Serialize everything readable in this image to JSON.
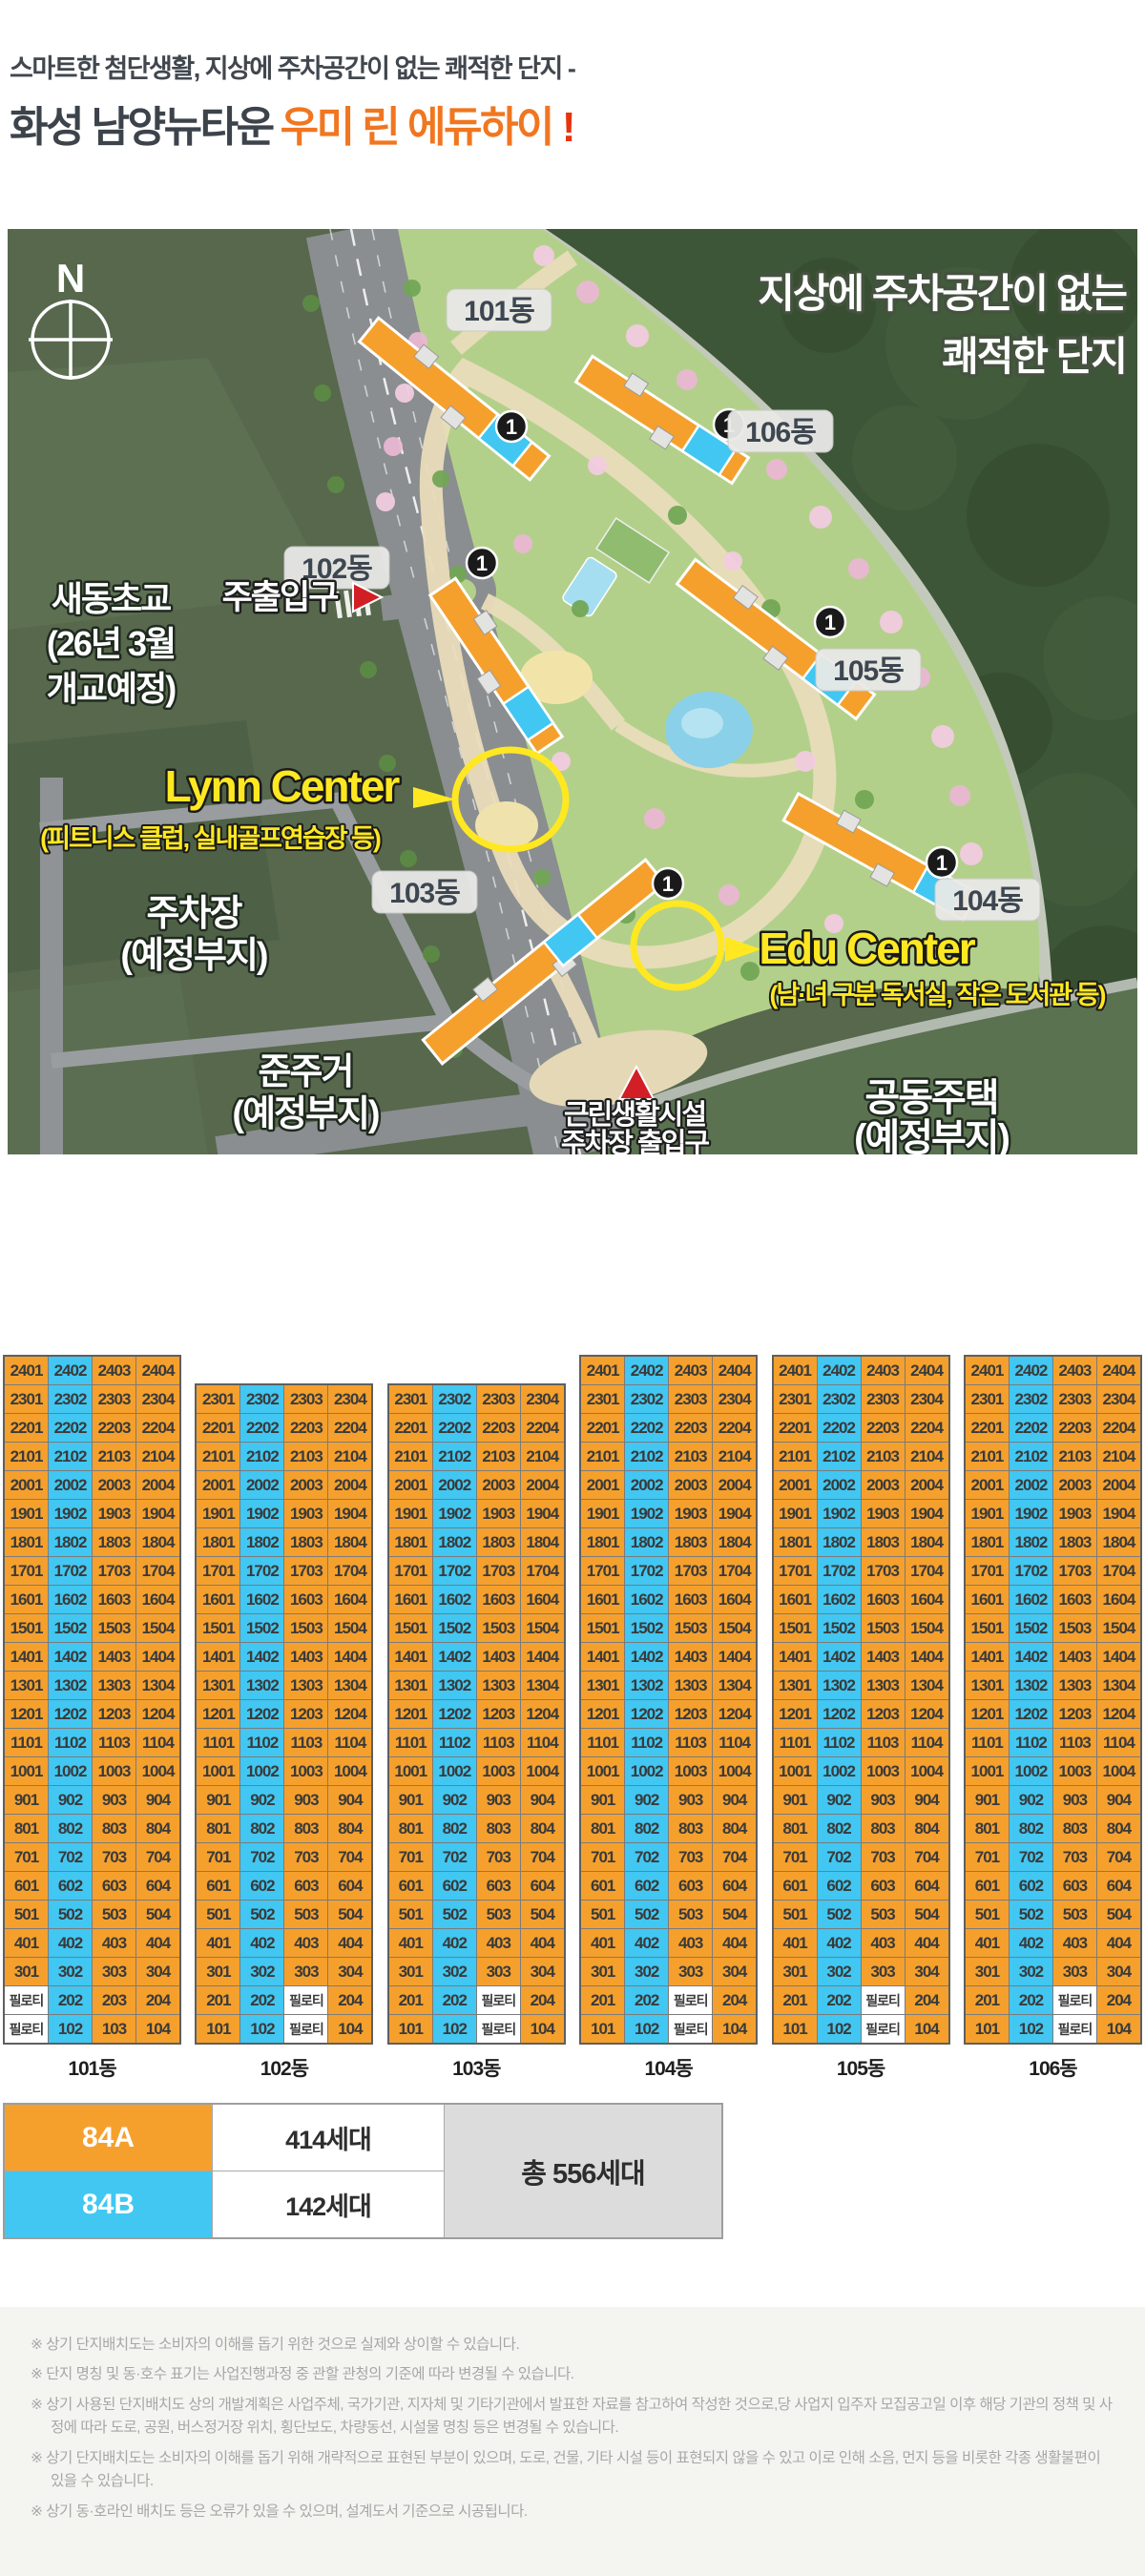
{
  "header": {
    "subtitle": "스마트한 첨단생활, 지상에 주차공간이 없는 쾌적한 단지 -",
    "title_dark": "화성 남양뉴타운",
    "title_orange": "우미 린 에듀하이",
    "title_bang": "!"
  },
  "map": {
    "compass": "N",
    "headline_line1": "지상에 주차공간이 없는",
    "headline_line2": "쾌적한 단지",
    "unit_marker": "1",
    "building_badges": [
      "101동",
      "106동",
      "102동",
      "105동",
      "103동",
      "104동"
    ],
    "annotations": {
      "main_entrance": "주출입구",
      "school_line1": "새동초교",
      "school_line2": "(26년 3월",
      "school_line3": "개교예정)",
      "lynn_title": "Lynn Center",
      "lynn_sub": "(피트니스 클럽, 실내골프연습장 등)",
      "edu_title": "Edu Center",
      "edu_sub": "(남·녀 구분 독서실, 작은 도서관 등)",
      "parking_line1": "주차장",
      "parking_line2": "(예정부지)",
      "semi_residential_line1": "준주거",
      "semi_residential_line2": "(예정부지)",
      "apartment_line1": "공동주택",
      "apartment_line2": "(예정부지)",
      "neighborhood_line1": "근린생활시설",
      "neighborhood_line2": "주차장 출입구"
    }
  },
  "stack_tables": {
    "piloti_label": "필로티",
    "columns": 4,
    "buildings": [
      {
        "label": "101동",
        "top_floor": 24,
        "blue_column": 2,
        "piloti_column": 1,
        "piloti_floors": [
          2,
          1
        ]
      },
      {
        "label": "102동",
        "top_floor": 23,
        "blue_column": 2,
        "piloti_column": 3,
        "piloti_floors": [
          2,
          1
        ]
      },
      {
        "label": "103동",
        "top_floor": 23,
        "blue_column": 2,
        "piloti_column": 3,
        "piloti_floors": [
          2,
          1
        ]
      },
      {
        "label": "104동",
        "top_floor": 24,
        "blue_column": 2,
        "piloti_column": 3,
        "piloti_floors": [
          2,
          1
        ]
      },
      {
        "label": "105동",
        "top_floor": 24,
        "blue_column": 2,
        "piloti_column": 3,
        "piloti_floors": [
          2,
          1
        ]
      },
      {
        "label": "106동",
        "top_floor": 24,
        "blue_column": 2,
        "piloti_column": 3,
        "piloti_floors": [
          2,
          1
        ]
      }
    ]
  },
  "legend": {
    "rows": [
      {
        "type": "84A",
        "count": "414세대"
      },
      {
        "type": "84B",
        "count": "142세대"
      }
    ],
    "total": "총 556세대"
  },
  "colors": {
    "type_84a": "#f5a02d",
    "type_84b": "#41c7f2",
    "accent_orange": "#f0761f",
    "accent_red": "#e7330e",
    "map_field_green": "#57684d",
    "map_forest_green": "#3e5638",
    "map_site_green": "#b3d08a"
  },
  "disclaimer_marker": "※",
  "disclaimers": [
    "상기 단지배치도는 소비자의 이해를 돕기 위한 것으로 실제와 상이할 수 있습니다.",
    "단지 명칭 및 동·호수 표기는 사업진행과정 중 관할 관청의 기준에 따라 변경될 수 있습니다.",
    "상기 사용된 단지배치도 상의 개발계획은 사업주체, 국가기관, 지자체 및 기타기관에서 발표한 자료를 참고하여 작성한 것으로,당 사업지 입주자 모집공고일 이후 해당 기관의 정책 및 사정에 따라 도로, 공원, 버스정거장 위치, 횡단보도, 차량동선, 시설물 명칭 등은 변경될 수 있습니다.",
    "상기 단지배치도는 소비자의 이해를 돕기 위해 개략적으로 표현된 부분이 있으며, 도로, 건물, 기타 시설 등이 표현되지 않을 수 있고 이로 인해 소음, 먼지 등을 비롯한 각종 생활불편이 있을 수 있습니다.",
    "상기 동·호라인 배치도 등은 오류가 있을 수 있으며, 설계도서 기준으로 시공됩니다."
  ]
}
